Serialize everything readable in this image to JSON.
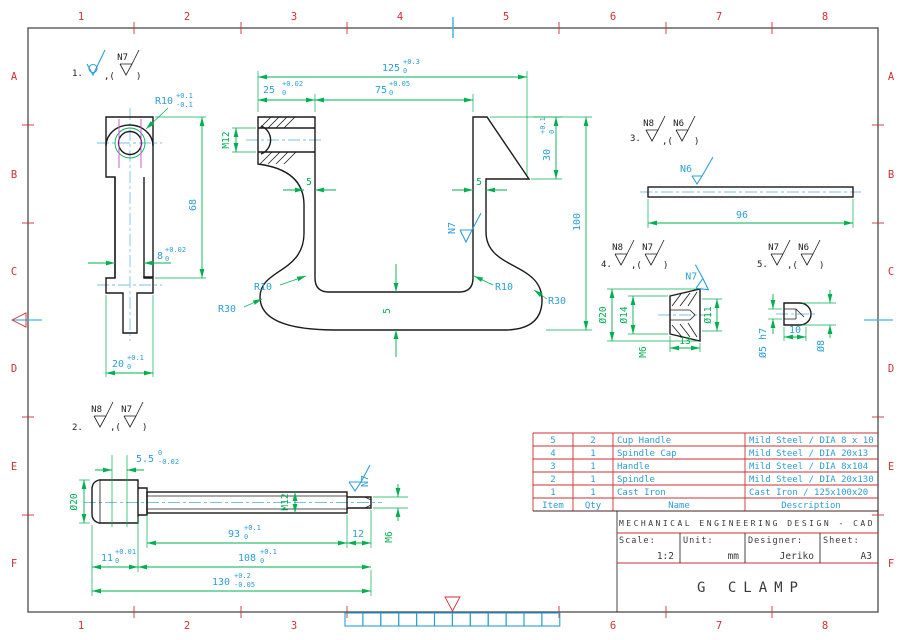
{
  "sheet": {
    "columns": [
      "1",
      "2",
      "3",
      "4",
      "5",
      "6",
      "7",
      "8"
    ],
    "rows": [
      "A",
      "B",
      "C",
      "D",
      "E",
      "F"
    ]
  },
  "colors": {
    "grid_red": "#cd3232",
    "dimension_green": "#00b050",
    "dimension_cyan": "#2b9fd4",
    "centerline_blue": "#7bbfe4",
    "thread_magenta": "#c84fc8",
    "line_black": "#1a1a1a"
  },
  "notes": {
    "comma": ",(",
    "close": ")",
    "n1": {
      "no": "1.",
      "b": "N7"
    },
    "n2": {
      "no": "2.",
      "a": "N8",
      "b": "N7"
    },
    "n3": {
      "no": "3.",
      "a": "N8",
      "b": "N6"
    },
    "n4": {
      "no": "4.",
      "a": "N8",
      "b": "N7"
    },
    "n5": {
      "no": "5.",
      "a": "N7",
      "b": "N6"
    }
  },
  "view1": {
    "dims": {
      "r10": {
        "v": "R10",
        "t": "+0.1",
        "b": "-0.1"
      },
      "h68": "68",
      "w8": {
        "v": "8",
        "t": "+0.02",
        "b": "0"
      },
      "w20": {
        "v": "20",
        "t": "+0.1",
        "b": "0"
      }
    }
  },
  "body": {
    "dims": {
      "d125": {
        "v": "125",
        "t": "+0.3",
        "b": "0"
      },
      "d25": {
        "v": "25",
        "t": "+0.02",
        "b": "0"
      },
      "d75": {
        "v": "75",
        "t": "+0.05",
        "b": "0"
      },
      "d30": {
        "v": "30",
        "t": "+0.1",
        "b": "0"
      },
      "d100": "100",
      "m12": "M12",
      "w5l": "5",
      "w5r": "5",
      "w5b": "5",
      "r10l": "R10",
      "r10r": "R10",
      "r30l": "R30",
      "r30r": "R30",
      "n7": "N7"
    }
  },
  "handle": {
    "dims": {
      "d96": "96",
      "n6": "N6"
    }
  },
  "cap": {
    "dims": {
      "dia20": "Ø20",
      "dia14": "Ø14",
      "m6": "M6",
      "d13": "13",
      "dia11": "Ø11",
      "n7": "N7"
    }
  },
  "cup": {
    "dims": {
      "dia5": "Ø5 h7",
      "d10": "10",
      "dia8": "Ø8"
    }
  },
  "spindle": {
    "dims": {
      "d55": {
        "v": "5.5",
        "t": "0",
        "b": "-0.02"
      },
      "dia20": "Ø20",
      "m12": "M12",
      "n7": "N7",
      "d93": {
        "v": "93",
        "t": "+0.1",
        "b": "0"
      },
      "d12": "12",
      "m6": "M6",
      "d11": {
        "v": "11",
        "t": "+0.01",
        "b": "0"
      },
      "d108": {
        "v": "108",
        "t": "+0.1",
        "b": "0"
      },
      "d130": {
        "v": "130",
        "t": "+0.2",
        "b": "-0.05"
      }
    }
  },
  "parts_table": {
    "headers": [
      "Item",
      "Qty",
      "Name",
      "Description"
    ],
    "rows": [
      [
        "5",
        "2",
        "Cup Handle",
        "Mild Steel / DIA 8 x 10"
      ],
      [
        "4",
        "1",
        "Spindle Cap",
        "Mild Steel / DIA 20x13"
      ],
      [
        "3",
        "1",
        "Handle",
        "Mild Steel / DIA 8x104"
      ],
      [
        "2",
        "1",
        "Spindle",
        "Mild Steel / DIA 20x130"
      ],
      [
        "1",
        "1",
        "Cast Iron",
        "Cast Iron / 125x100x20"
      ]
    ]
  },
  "title_block": {
    "org": "MECHANICAL ENGINEERING DESIGN - CAD",
    "scale_label": "Scale:",
    "scale": "1:2",
    "unit_label": "Unit:",
    "unit": "mm",
    "designer_label": "Designer:",
    "designer": "Jeriko",
    "sheet_label": "Sheet:",
    "sheet": "A3",
    "drawing_title": "G CLAMP"
  }
}
